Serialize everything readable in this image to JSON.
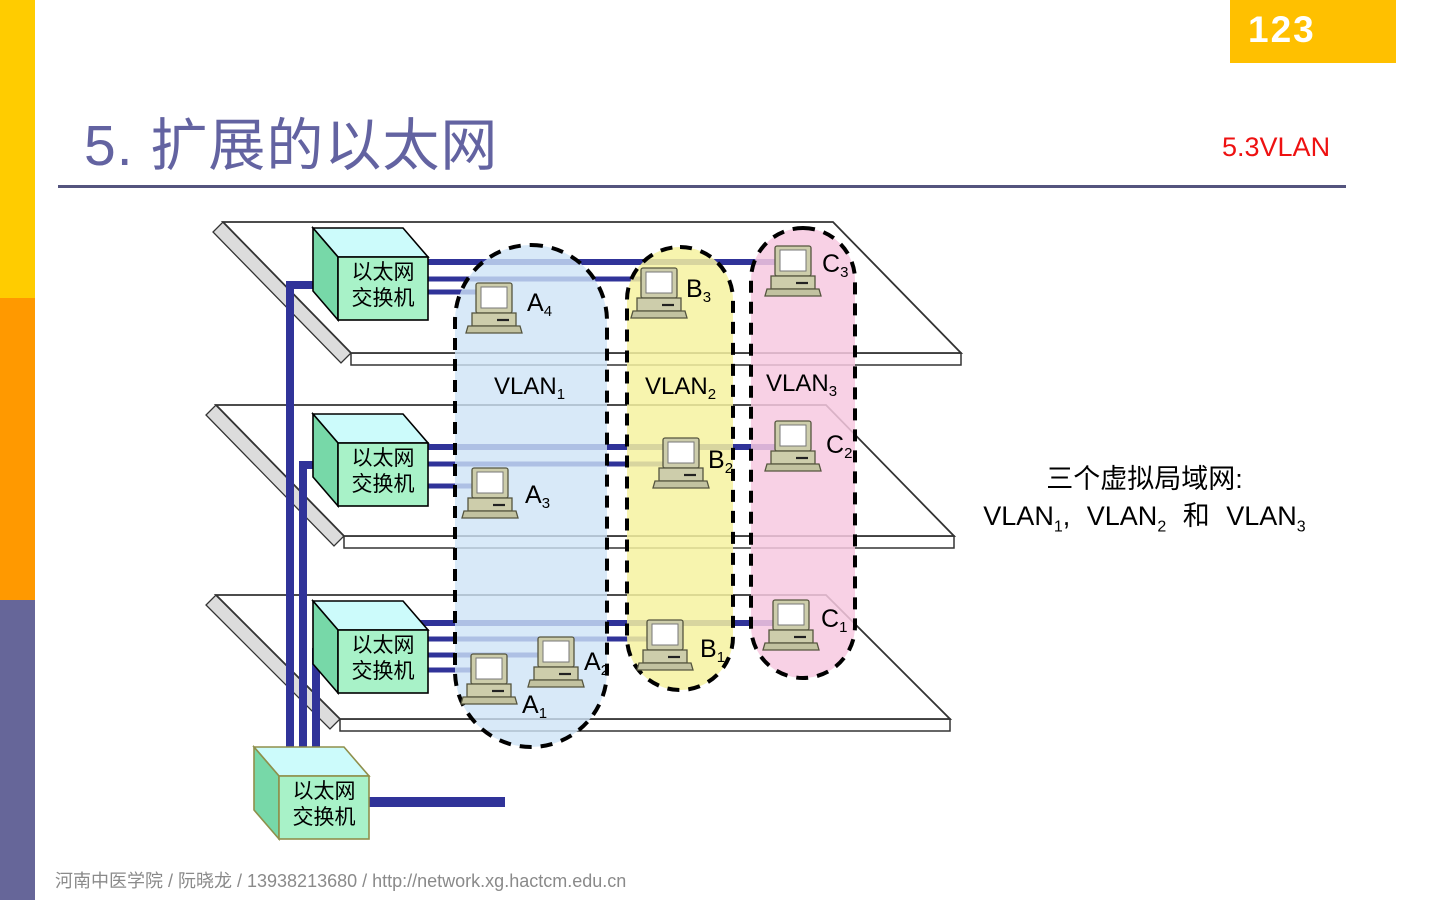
{
  "slide": {
    "page_number": "123",
    "title": "5. 扩展的以太网",
    "section": "5.3VLAN",
    "footer": "河南中医学院  /  阮晓龙  / 13938213680 / http://network.xg.hactcm.edu.cn"
  },
  "annotation": {
    "line1": "三个虚拟局域网:",
    "vlan_word": "VLAN",
    "subs": [
      "1",
      "2",
      "3"
    ],
    "comma": ",",
    "and_word": "和"
  },
  "switch_label": {
    "line1": "以太网",
    "line2": "交换机"
  },
  "vlan_groups": [
    {
      "label": "VLAN",
      "sub": "1"
    },
    {
      "label": "VLAN",
      "sub": "2"
    },
    {
      "label": "VLAN",
      "sub": "3"
    }
  ],
  "computers": [
    {
      "base": "A",
      "sub": "4"
    },
    {
      "base": "B",
      "sub": "3"
    },
    {
      "base": "C",
      "sub": "3"
    },
    {
      "base": "A",
      "sub": "3"
    },
    {
      "base": "B",
      "sub": "2"
    },
    {
      "base": "C",
      "sub": "2"
    },
    {
      "base": "A",
      "sub": "2"
    },
    {
      "base": "A",
      "sub": "1"
    },
    {
      "base": "B",
      "sub": "1"
    },
    {
      "base": "C",
      "sub": "1"
    }
  ],
  "colors": {
    "accent_yellow": "#FFCC00",
    "accent_orange": "#FF9900",
    "accent_purple": "#666699",
    "badge_bg": "#FFC000",
    "badge_text": "#FFFFFF",
    "title_color": "#6363A1",
    "underline_color": "#54547E",
    "section_color": "#EE1111",
    "footer_color": "#8A8A8A",
    "line_navy": "#303399",
    "vlan1_fill": "#CEE3F6",
    "vlan2_fill": "#F6F2A0",
    "vlan3_fill": "#F7C9E1",
    "switch_top": "#CCFBFB",
    "switch_front": "#A8F2C8",
    "switch_side": "#77D8A8",
    "switch4_stroke": "#8F8F4B",
    "pc_body": "#CDCDAB",
    "pc_base": "#C2C2A0",
    "plane_fill": "#FFFFFF",
    "plane_stroke": "#333333",
    "plane_edge": "#DCDCDC"
  }
}
